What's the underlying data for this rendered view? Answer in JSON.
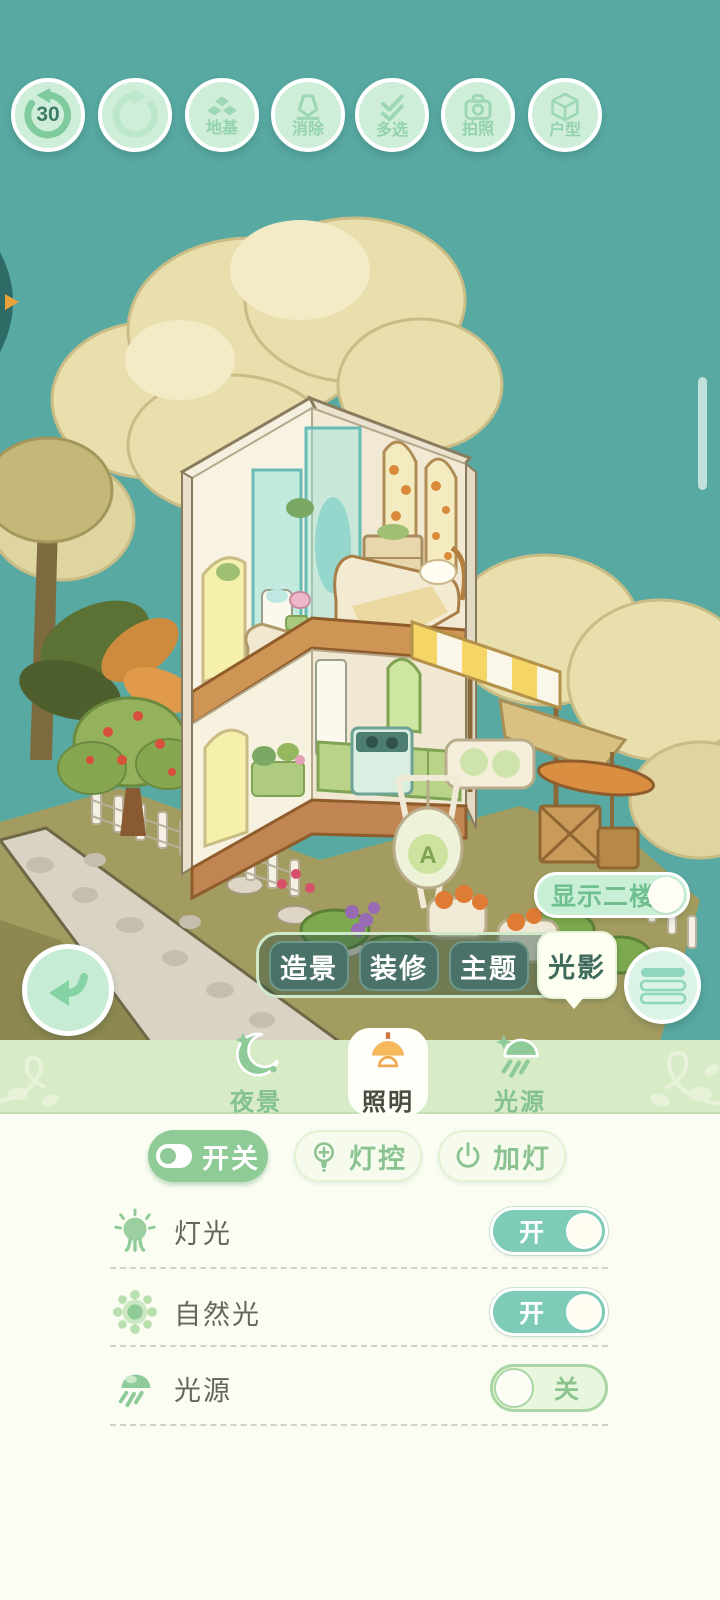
{
  "toolbar": {
    "undo_count": "30",
    "foundation_label": "地基",
    "erase_label": "消除",
    "multiselect_label": "多选",
    "photo_label": "拍照",
    "layout_label": "户型"
  },
  "scene": {
    "show_second_floor": "显示二楼"
  },
  "mode_tabs": {
    "landscape": "造景",
    "decorate": "装修",
    "theme": "主题",
    "lighting": "光影",
    "selected": "光影"
  },
  "panel": {
    "tabs": {
      "night": "夜景",
      "illumination": "照明",
      "source": "光源",
      "selected": "照明"
    },
    "actions": {
      "switch": "开关",
      "control": "灯控",
      "add": "加灯",
      "selected": "开关"
    },
    "rows": [
      {
        "label": "灯光",
        "state": "开"
      },
      {
        "label": "自然光",
        "state": "开"
      },
      {
        "label": "光源",
        "state": "关"
      }
    ]
  },
  "colors": {
    "sky": "#58a9a2",
    "accent_green": "#8fcb96",
    "toggle_on": "#7eccb8",
    "toggle_off_track": "#e9f6de",
    "panel_header": "#d8ebc7",
    "panel_bg": "#fbfdf3",
    "mode_tab_dark": "#4a7268",
    "mode_tab_selected_bg": "#fdfff1",
    "lamp_orange": "#f5b95c",
    "mint_button": "#cfeeda"
  }
}
